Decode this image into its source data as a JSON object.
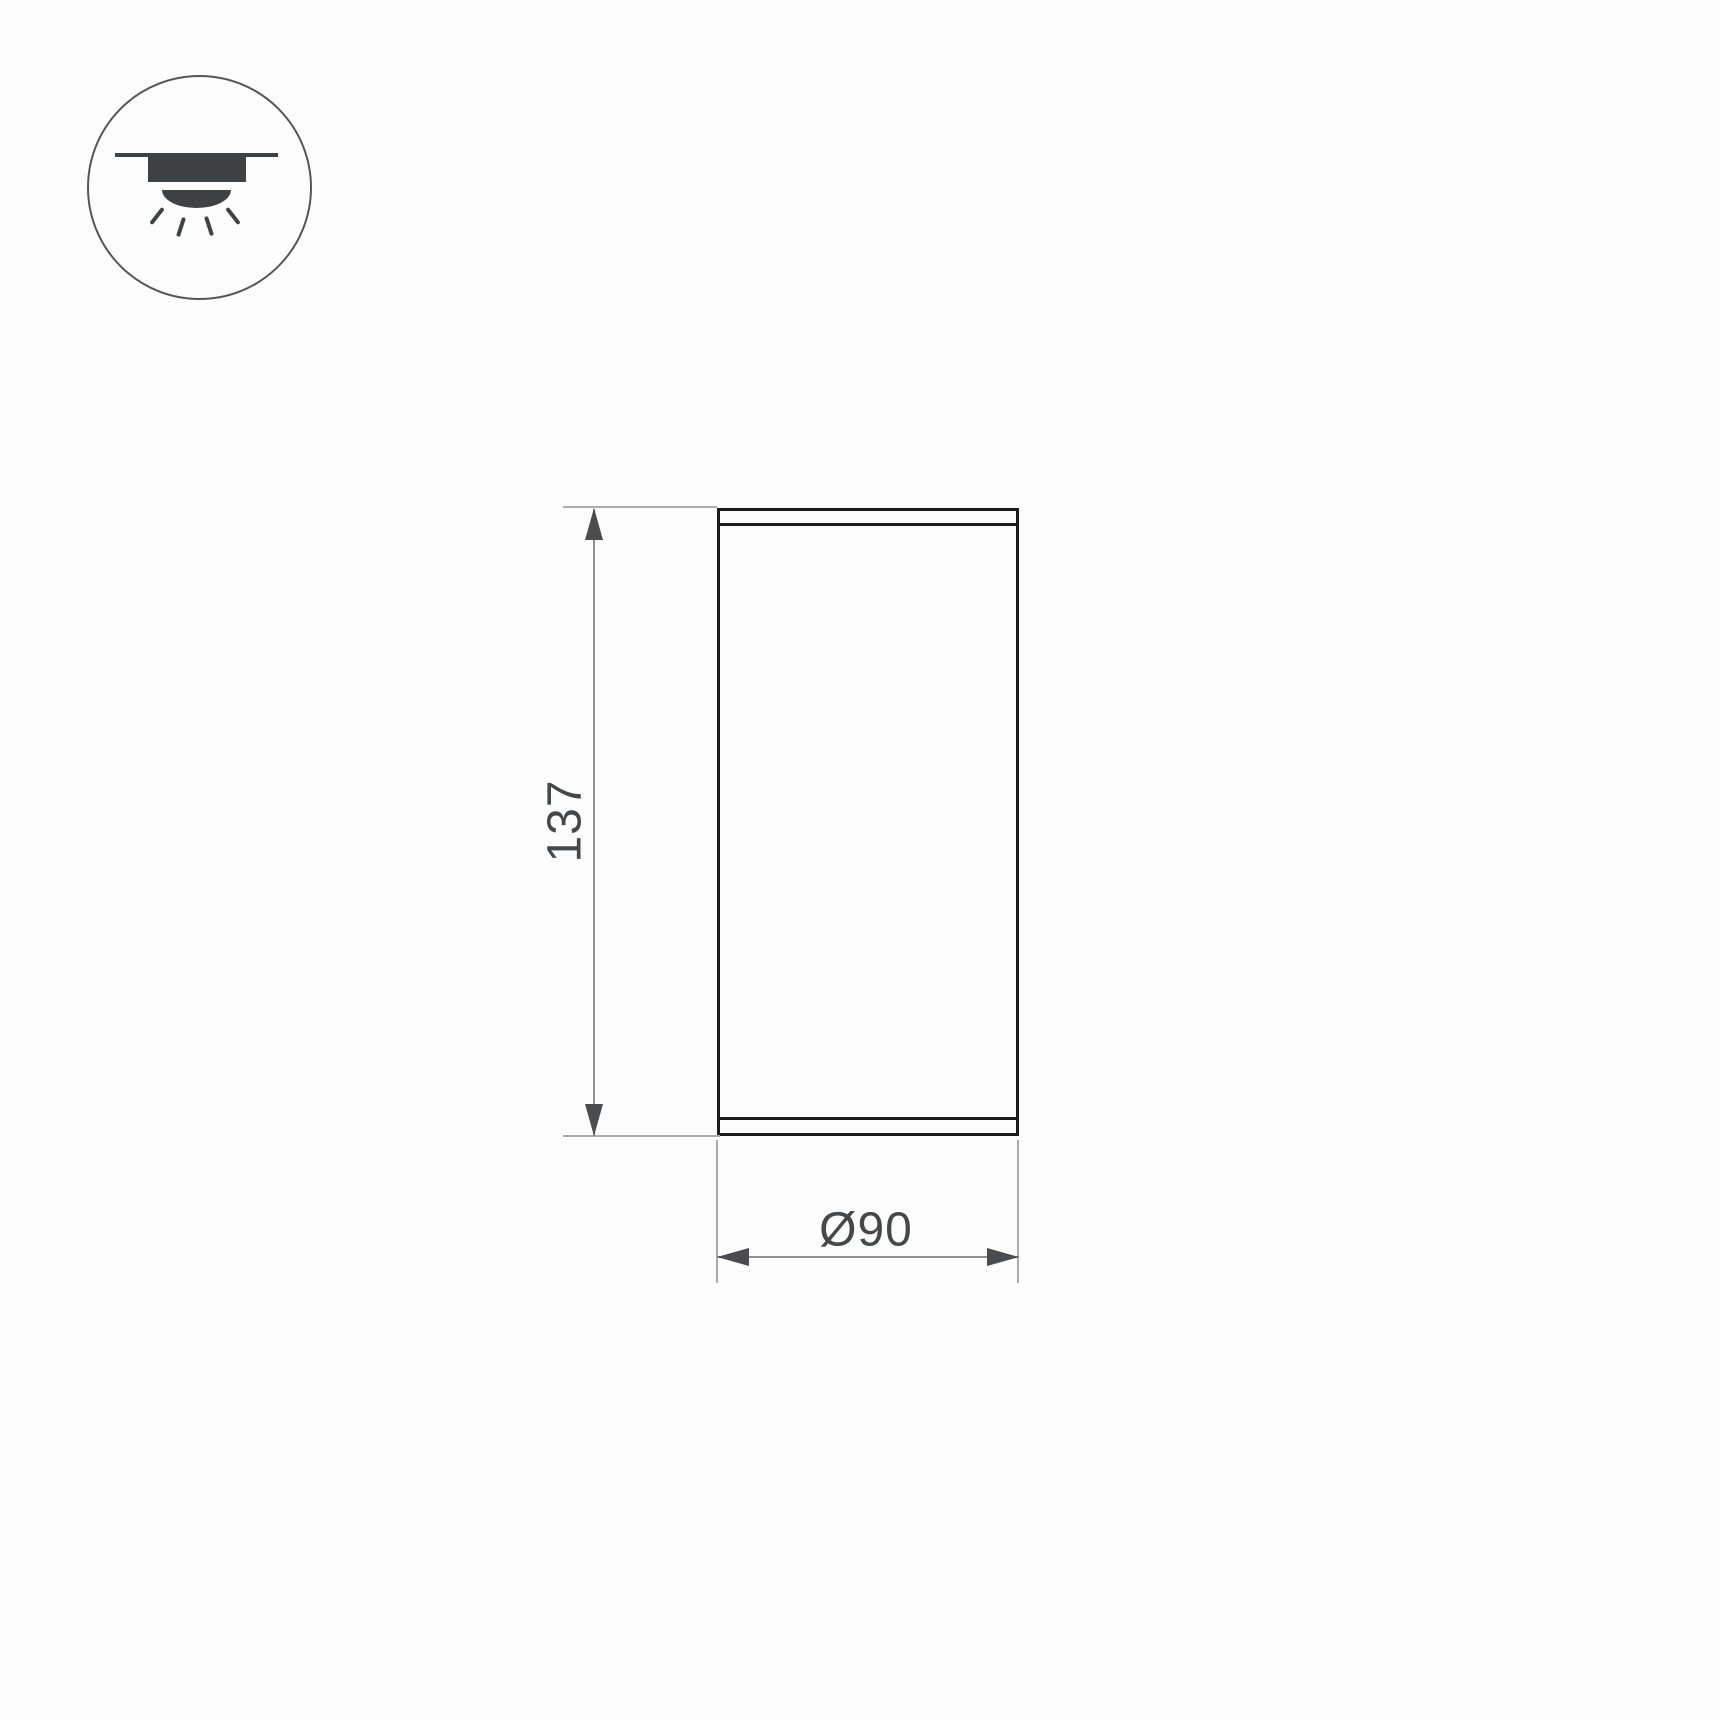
{
  "mount_icon": {
    "meaning": "surface-mounted-ceiling-downlight",
    "parts": [
      "ceiling-line",
      "fixture-body",
      "light-dome",
      "light-rays"
    ]
  },
  "drawing": {
    "view": "fixture-front-elevation",
    "dimensions": {
      "height": {
        "value": "137"
      },
      "diameter": {
        "value": "Ø90"
      }
    }
  },
  "colors": {
    "bg": "#fcfcfc",
    "stroke-dark": "#1c1c1c",
    "line-ext": "#ababab",
    "line-dim": "#8f8f8f",
    "arrow": "#4a4d50",
    "text": "#45484b",
    "icon-dark": "#3f4245",
    "icon-ring": "#54575a"
  }
}
